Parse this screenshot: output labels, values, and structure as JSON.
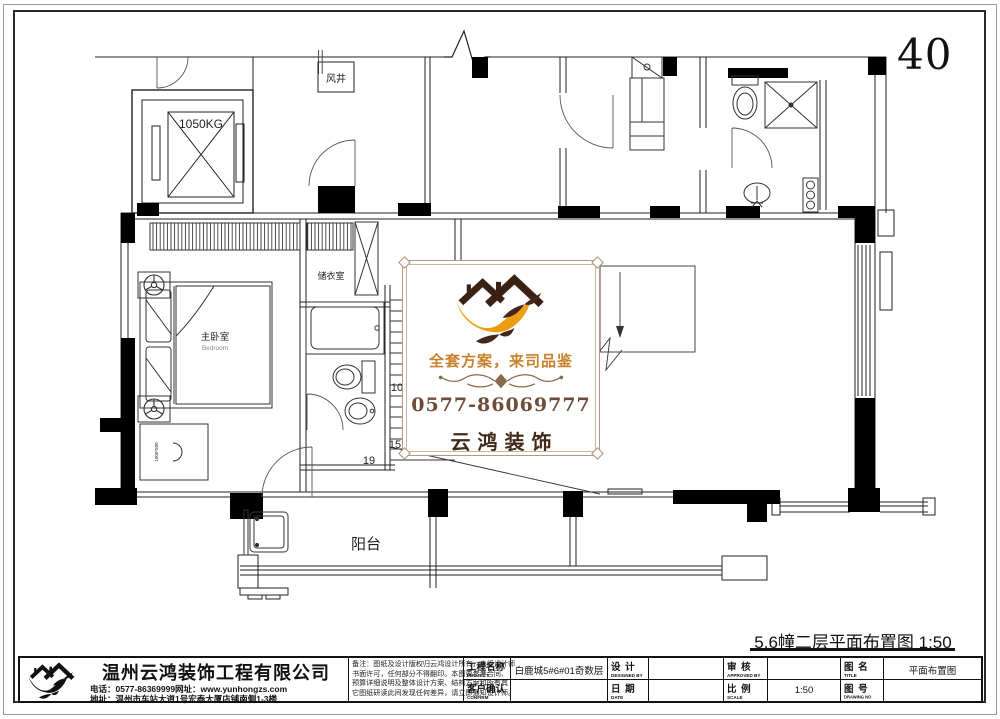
{
  "page": {
    "number": "40",
    "drawing_title": "5.6幢二层平面布置图 1:50"
  },
  "plan_labels": {
    "elevator_capacity": "1050KG",
    "wind_shaft": "风井",
    "storage_room": "储衣室",
    "master_bedroom": "主卧室",
    "master_bedroom_en": "Bedroom",
    "balcony": "阳台",
    "stair_count_5": "5",
    "stair_count_10": "10",
    "stair_count_15": "15",
    "stair_count_19": "19",
    "cabinet_size": "1000*500"
  },
  "watermark": {
    "tagline": "全套方案，来司品鉴",
    "phone": "0577-86069777",
    "brand": "云鸿装饰",
    "colors": {
      "accent_orange": "#F2A21B",
      "brand_brown": "#42281A",
      "tagline_brown": "#C8812C"
    }
  },
  "title_block": {
    "company": {
      "name": "温州云鸿装饰工程有限公司",
      "phone_line": "电话：0577-86369999网址：www.yunhongzs.com",
      "address_line": "地址：温州市车站大道1号宏泰大厦店铺南侧1-3楼"
    },
    "notes": [
      "备注：图纸及设计版权归云鸿设计所有，未经设计师",
      "书面许可，任何部分不得翻印。本图要参考合同、",
      "预算详细说明及整体设计方案、结构方案和所有其",
      "它图纸研读此间发现任何差异，请立即通知设计师。"
    ],
    "fields": {
      "project_label": "工程名称",
      "project_label_en": "PROJECT",
      "project_value": "白鹿城5#6#01奇数层",
      "designed_label": "设 计",
      "designed_label_en": "DESIGNED BY",
      "designed_value": "",
      "approved_label": "审 核",
      "approved_label_en": "APPROVED BY",
      "approved_value": "",
      "title_label": "图 名",
      "title_label_en": "TITLE",
      "title_value": "平面布置图",
      "confirm_label": "客户确认",
      "confirm_label_en": "CONFIRM",
      "confirm_value": "",
      "date_label": "日 期",
      "date_label_en": "DATE",
      "date_value": "",
      "scale_label": "比 例",
      "scale_label_en": "SCALE",
      "scale_value": "1:50",
      "drawing_no_label": "图 号",
      "drawing_no_label_en": "DRAWING NO",
      "drawing_no_value": ""
    }
  }
}
